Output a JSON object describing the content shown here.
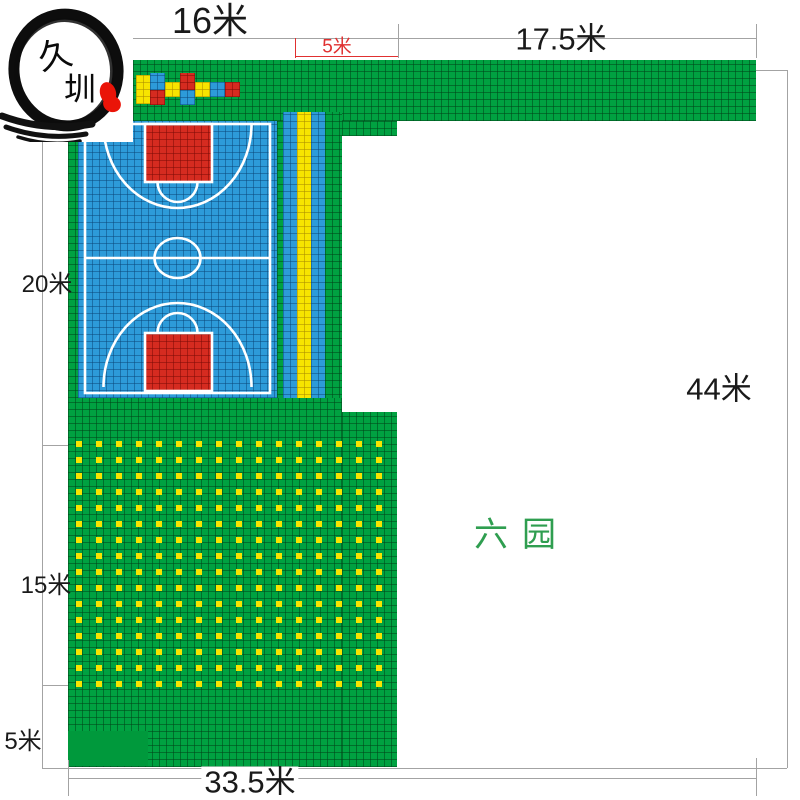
{
  "logo": {
    "char1": "久",
    "char2": "圳"
  },
  "labels": {
    "top_width": "16米",
    "top_section": "5米",
    "top_right_width": "17.5米",
    "right_height": "44米",
    "left_court_height": "20米",
    "left_field_height": "15米",
    "left_bottom_height": "5米",
    "bottom_width": "33.5米",
    "area_name": "六园"
  },
  "colors": {
    "tile_green": "#00a141",
    "tile_blue": "#2d9bd9",
    "tile_yellow": "#f7e400",
    "tile_red": "#d52b20",
    "dimension_line": "#a3a3a3",
    "dimension_red": "#e03030",
    "area_name_green": "#2f9e50"
  },
  "pattern": {
    "dot_rows": 16,
    "dot_cols": 16,
    "dot_color": "#f7e400"
  }
}
